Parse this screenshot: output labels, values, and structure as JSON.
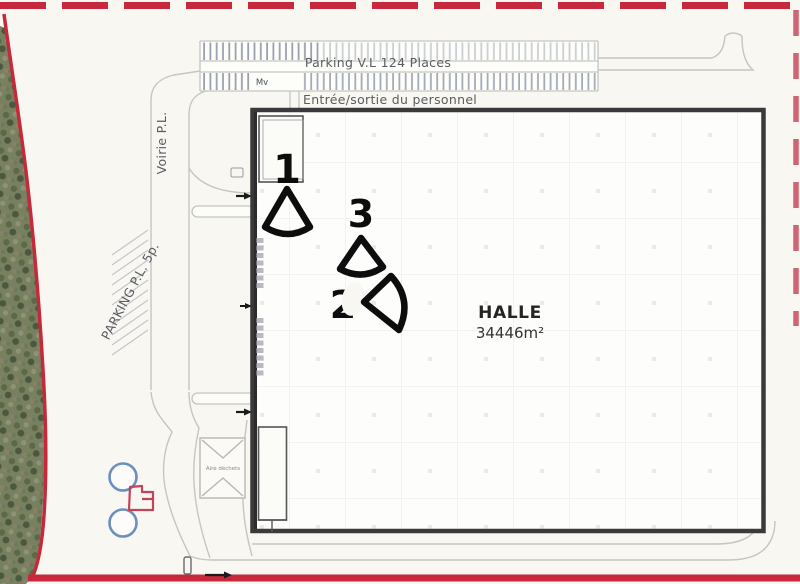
{
  "labels": {
    "parking_vl": "Parking V.L 124 Places",
    "entrance": "Entrée/sortie du personnel",
    "voirie": "Voirie P.L.",
    "parking_pl": "PARKING P.L. 5p.",
    "hall_name": "HALLE",
    "hall_area": "34446m²",
    "waste_area": "Aire déchets",
    "parking_note": "Mv"
  },
  "markers": {
    "m1": "1",
    "m2": "2",
    "m3": "3"
  },
  "colors": {
    "boundary_red": "#c5293b",
    "boundary_red_dashed": "#c84b5c",
    "building_stroke": "#3a3a3a",
    "road_gray": "#c6c5c0",
    "hatch_gray": "#8e97a6",
    "hydrant_blue": "#6a8fc0",
    "structure_red": "#c24458",
    "marker_black": "#0d0d0d",
    "paper": "#f9f7f1"
  }
}
